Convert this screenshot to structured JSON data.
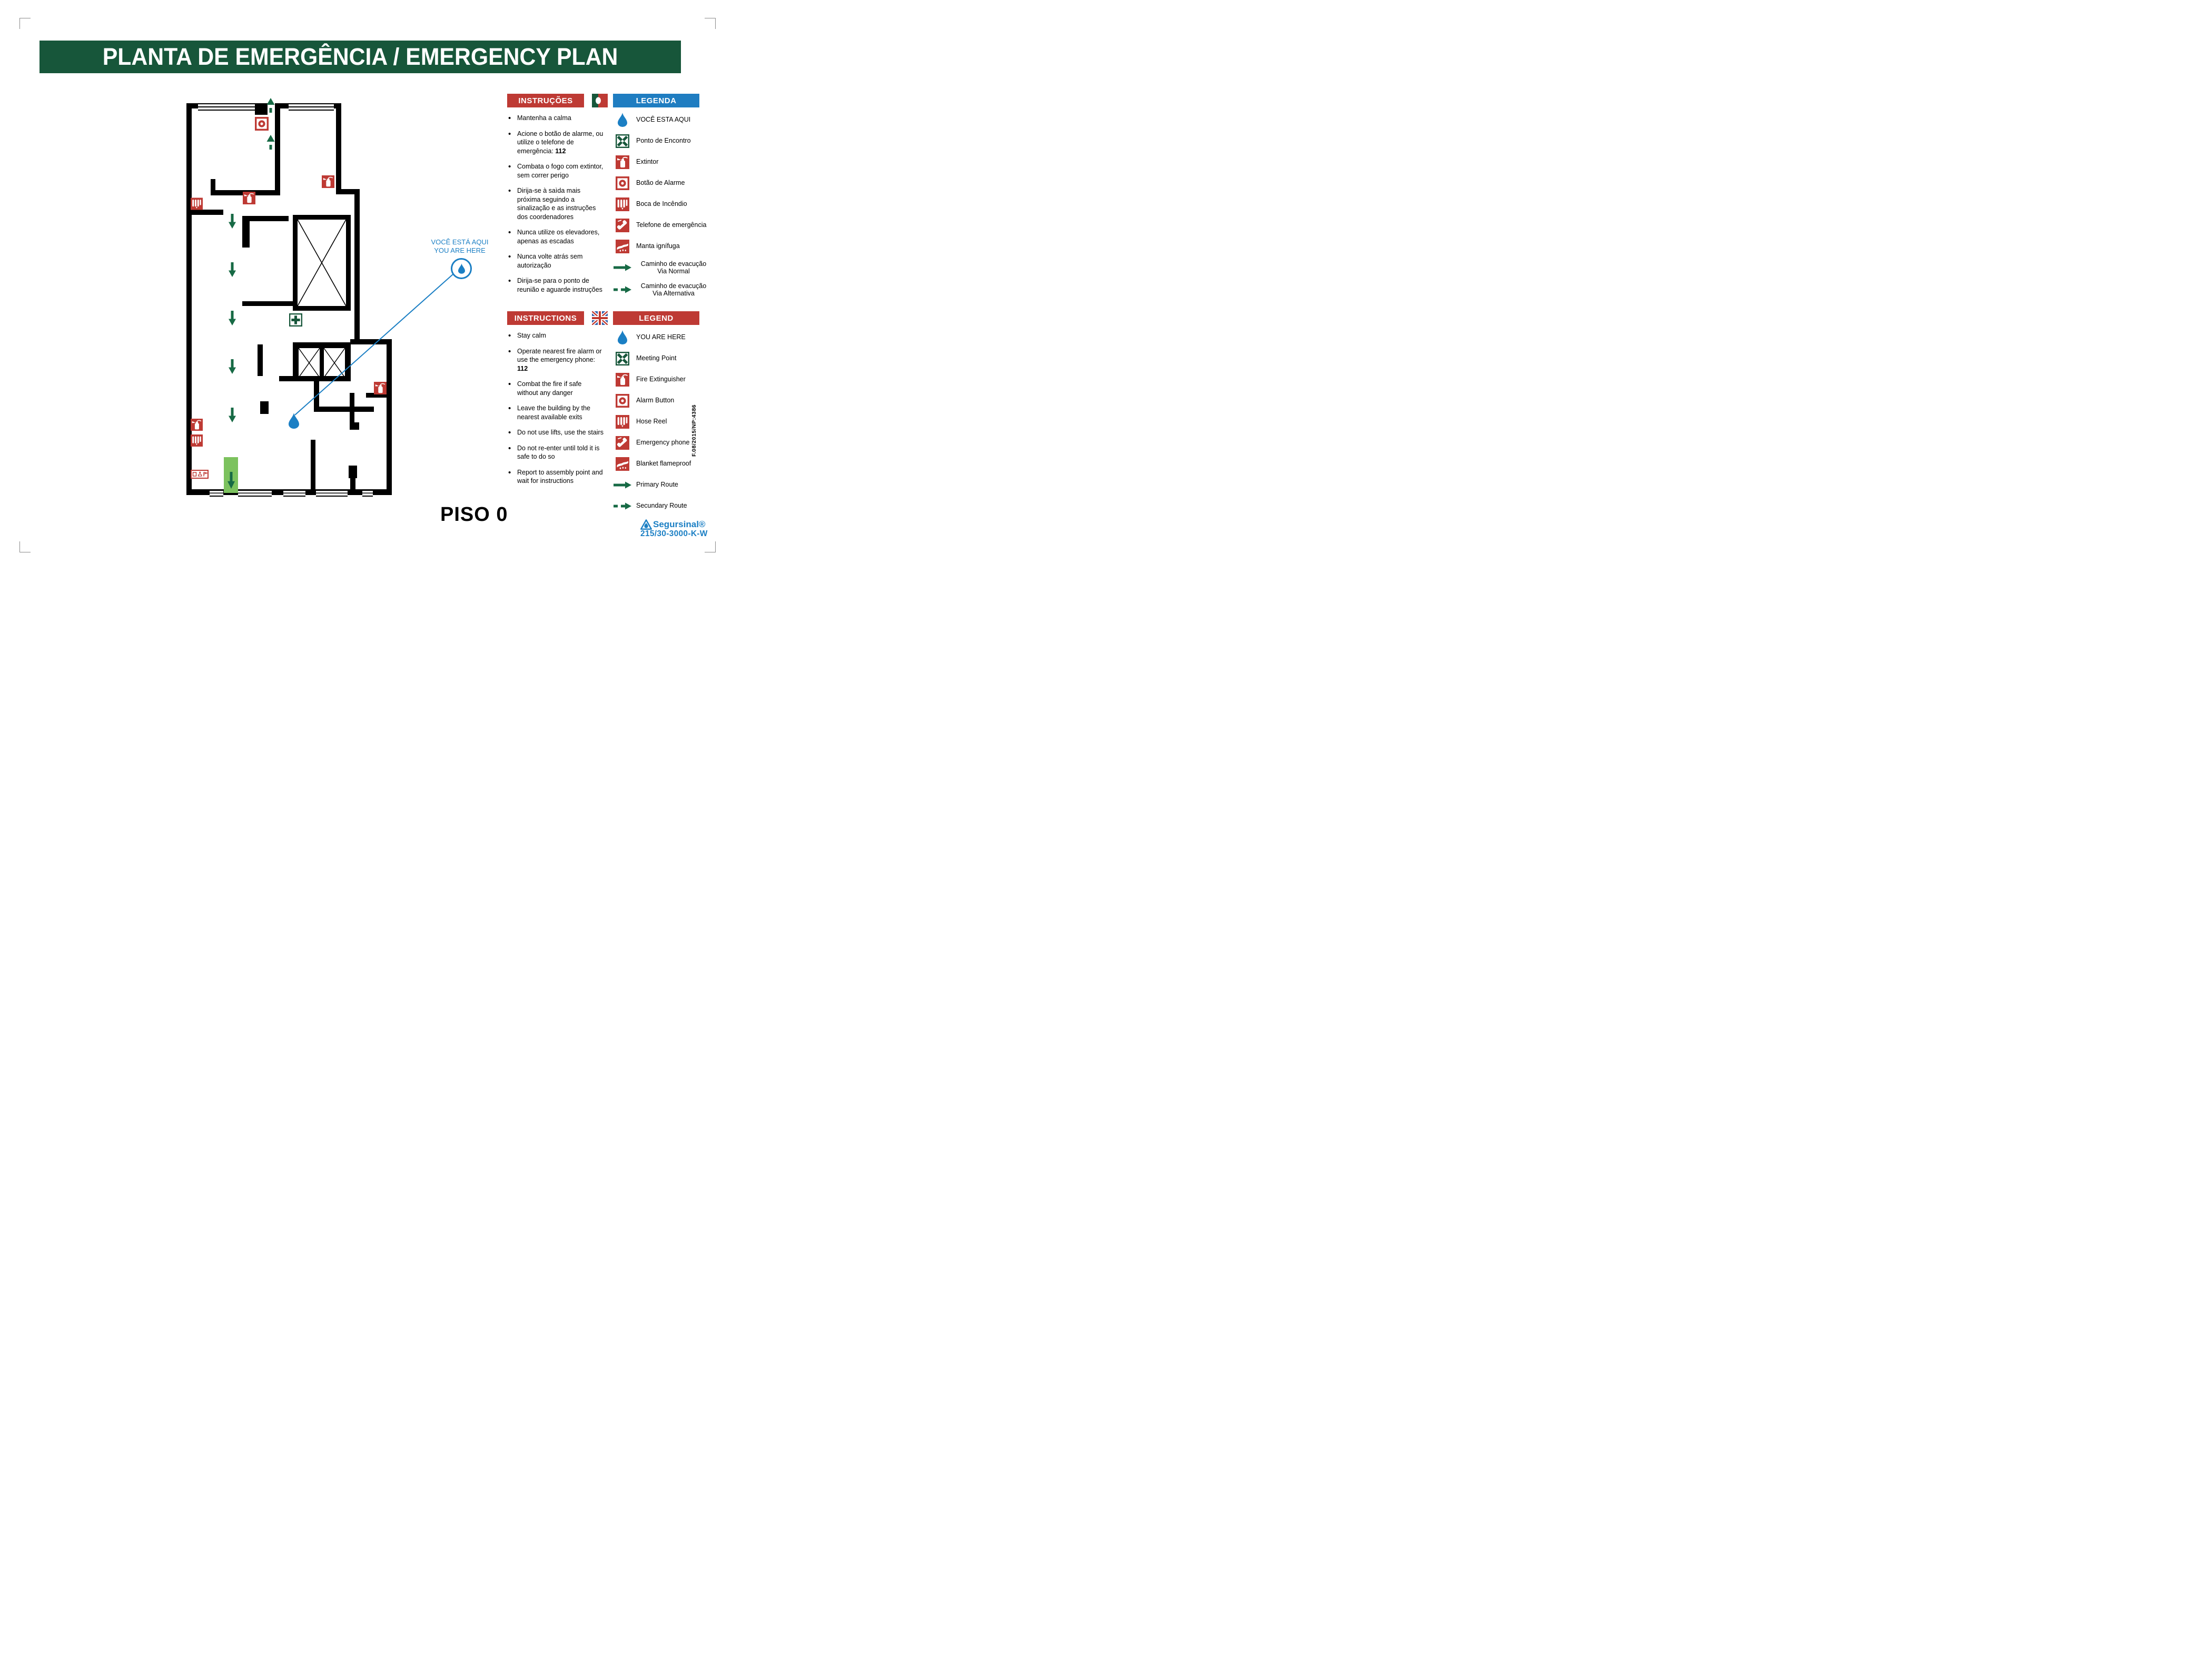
{
  "title": "PLANTA DE EMERGÊNCIA / EMERGENCY PLAN",
  "floor_label": "PISO 0",
  "callout": {
    "line1": "VOCÊ ESTÁ AQUI",
    "line2": "YOU ARE HERE"
  },
  "pt": {
    "instructions_title": "INSTRUÇÕES",
    "legend_title": "LEGENDA",
    "instructions": [
      {
        "text": "Mantenha a calma"
      },
      {
        "text": "Acione o botão de alarme, ou utilize o telefone de emergência: ",
        "bold": "112"
      },
      {
        "text": "Combata o fogo com extintor, sem correr perigo"
      },
      {
        "text": "Dirija-se à saìda mais próxima seguindo a sinalização e as instruções dos coordenadores"
      },
      {
        "text": "Nunca utilize os elevadores, apenas as escadas"
      },
      {
        "text": "Nunca volte atrás sem autorização"
      },
      {
        "text": "Dirija-se para o ponto de reunião e aguarde instruções"
      }
    ],
    "legend": [
      {
        "icon": "droplet",
        "label": "VOCÊ ESTA AQUI"
      },
      {
        "icon": "meeting-point",
        "label": "Ponto de Encontro"
      },
      {
        "icon": "fire-extinguisher",
        "label": "Extintor"
      },
      {
        "icon": "alarm-button",
        "label": "Botão de Alarme"
      },
      {
        "icon": "hose-reel",
        "label": "Boca de Incêndio"
      },
      {
        "icon": "emergency-phone",
        "label": "Telefone de emergência"
      },
      {
        "icon": "fire-blanket",
        "label": "Manta ignífuga"
      },
      {
        "icon": "arrow-solid",
        "label": "Caminho de evacução",
        "label2": "Via Normal"
      },
      {
        "icon": "arrow-dashed",
        "label": "Caminho de evacução",
        "label2": "Via Alternativa"
      }
    ]
  },
  "en": {
    "instructions_title": "INSTRUCTIONS",
    "legend_title": "LEGEND",
    "instructions": [
      {
        "text": "Stay calm"
      },
      {
        "text": "Operate nearest fire alarm or use the emergency phone: ",
        "bold": "112"
      },
      {
        "text": "Combat the fire if safe without any danger"
      },
      {
        "text": "Leave the building by the nearest available exits"
      },
      {
        "text": "Do not use lifts, use the stairs"
      },
      {
        "text": "Do not re-enter until told it is safe to do so"
      },
      {
        "text": "Report to assembly point and wait for instructions"
      }
    ],
    "legend": [
      {
        "icon": "droplet",
        "label": "YOU ARE HERE"
      },
      {
        "icon": "meeting-point",
        "label": "Meeting Point"
      },
      {
        "icon": "fire-extinguisher",
        "label": "Fire Extinguisher"
      },
      {
        "icon": "alarm-button",
        "label": "Alarm Button"
      },
      {
        "icon": "hose-reel",
        "label": "Hose Reel"
      },
      {
        "icon": "emergency-phone",
        "label": "Emergency phone"
      },
      {
        "icon": "fire-blanket",
        "label": "Blanket flameproof"
      },
      {
        "icon": "arrow-solid",
        "label": "Primary Route"
      },
      {
        "icon": "arrow-dashed",
        "label": "Secundary Route"
      }
    ]
  },
  "brand": {
    "name": "Segursinal®",
    "code": "215/30-3000-K-W",
    "doc_ref": "F.08/2015/NP:4386"
  },
  "colors": {
    "banner_green": "#17563A",
    "signal_red": "#BE3A34",
    "legend_blue": "#1F7DC1",
    "marker_blue": "#1B7FC4",
    "exit_green": "#7CC25E",
    "route_green": "#176A45"
  }
}
